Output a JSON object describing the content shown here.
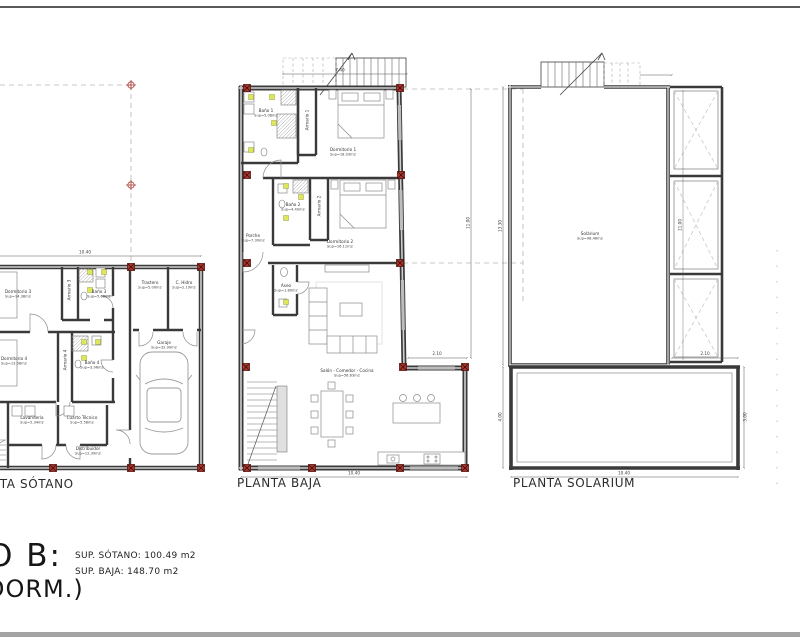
{
  "title_block": {
    "big_text_line1": "O B:",
    "big_text_line2": "DORM.)",
    "sup_sotano": "SUP. SÓTANO: 100.49 m2",
    "sup_baja": "SUP. BAJA: 148.70 m2"
  },
  "plans": {
    "sotano": {
      "title": "PLANTA SÓTANO",
      "rooms": {
        "dorm3": {
          "name": "Dormitorio 3",
          "area": "Sup=14.38m2"
        },
        "armario3": {
          "name": "Armario 3"
        },
        "bano3": {
          "name": "Baño 3",
          "area": "Sup=5.08m2"
        },
        "trastero": {
          "name": "Trastero",
          "area": "Sup=5.00m2"
        },
        "chidro": {
          "name": "C. Hidro",
          "area": "Sup=2.19m2"
        },
        "dorm4": {
          "name": "Dormitorio 4",
          "area": "Sup=13.58m2"
        },
        "armario4": {
          "name": "Armario 4"
        },
        "bano4": {
          "name": "Baño 4",
          "area": "Sup=3.96m2"
        },
        "lavanderia": {
          "name": "Lavandería",
          "area": "Sup=5.34m2"
        },
        "cuarto_tecnico": {
          "name": "Cuarto Técnico",
          "area": "Sup=5.58m2"
        },
        "distribuidor": {
          "name": "Distribuidor",
          "area": "Sup=12.39m2"
        },
        "garaje": {
          "name": "Garaje",
          "area": "Sup=32.99m2"
        }
      },
      "dims": {
        "width": "10.40"
      }
    },
    "baja": {
      "title": "PLANTA BAJA",
      "rooms": {
        "bano1": {
          "name": "Baño 1",
          "area": "Sup=5.08m2"
        },
        "armario1": {
          "name": "Armario 1"
        },
        "dorm1": {
          "name": "Dormitorio 1",
          "area": "Sup=18.03m2"
        },
        "bano2": {
          "name": "Baño 2",
          "area": "Sup=4.40m2"
        },
        "armario2": {
          "name": "Armario 2"
        },
        "dorm2": {
          "name": "Dormitorio 2",
          "area": "Sup=16.11m2"
        },
        "porche": {
          "name": "Porche",
          "area": "Sup=7.30m2"
        },
        "aseo": {
          "name": "Aseo",
          "area": "Sup=1.80m2"
        },
        "salon": {
          "name": "Salón - Comedor - Cocina",
          "area": "Sup=56.63m2"
        }
      },
      "dims": {
        "top": "7.40",
        "right": "11.00",
        "step": "2.10",
        "bottom": "10.40"
      }
    },
    "solarium": {
      "title": "PLANTA SOLARIUM",
      "rooms": {
        "solarium": {
          "name": "Solárium",
          "area": "Sup=98.46m2"
        }
      },
      "dims": {
        "left_upper": "13.30",
        "left_lower": "4.00",
        "panel": "11.00",
        "step": "2.10",
        "right_lower": "3.00",
        "bottom": "10.40"
      }
    }
  }
}
